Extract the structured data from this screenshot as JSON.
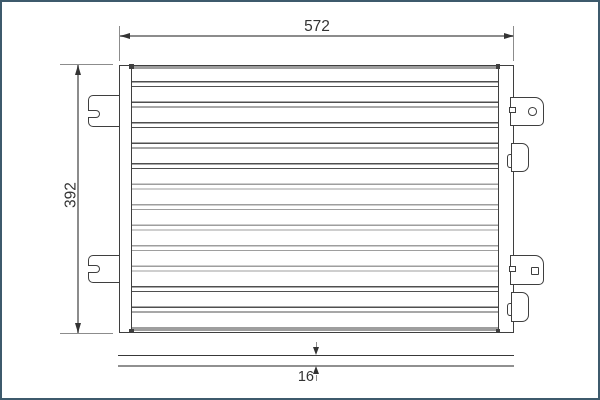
{
  "dimensions": {
    "width": {
      "value": "572"
    },
    "height": {
      "value": "392"
    },
    "thickness": {
      "value": "16"
    }
  },
  "colors": {
    "frame": "#3d5a6c",
    "background": "#ffffff",
    "outline": "#3f3f3f",
    "dim-line": "#8c8c8c",
    "dim-text": "#333333",
    "tube-dark": "#4f4f4f",
    "tube-light": "#9e9e9e",
    "plate-dark": "#383838",
    "plate-light": "#909090"
  }
}
